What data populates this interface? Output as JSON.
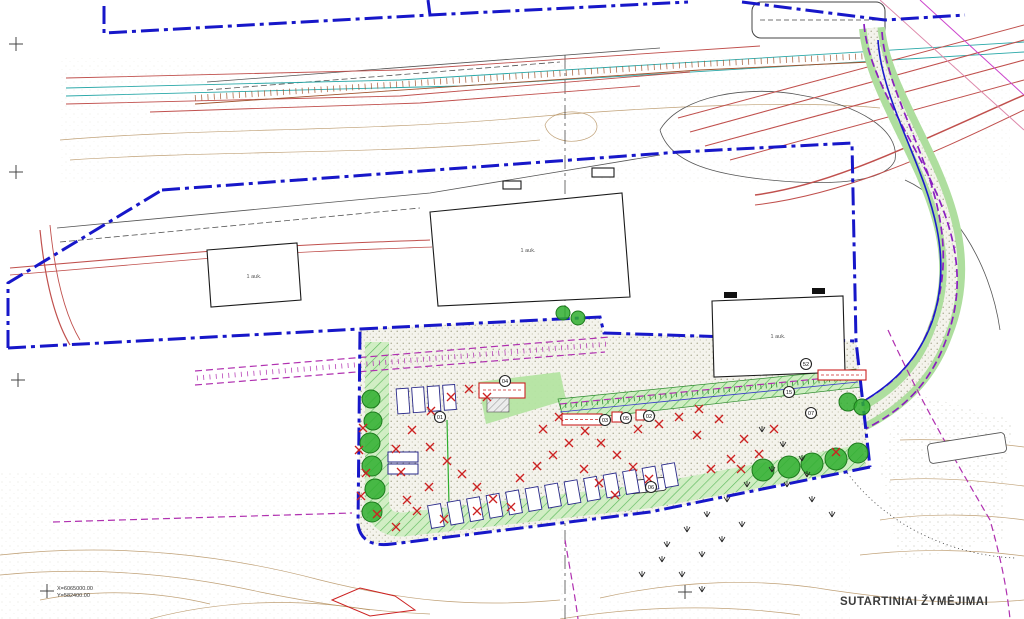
{
  "title": {
    "legend": "SUTARTINIAI ŽYMĖJIMAI"
  },
  "coordinates": {
    "x": "X=6065000.00",
    "y": "Y=582400.00"
  },
  "colors": {
    "boundary": "#1717c9",
    "magenta": "#b030b0",
    "purple": "#8a1fc0",
    "red": "#c0504d",
    "redx": "#cc2222",
    "teal": "#2aa8a8",
    "tree": "#2fae2f",
    "green_fill": "#aede9e"
  },
  "buildings": [
    {
      "label": "1 auk.",
      "x": 254,
      "y": 278
    },
    {
      "label": "1 auk.",
      "x": 528,
      "y": 252
    },
    {
      "label": "1 auk.",
      "x": 778,
      "y": 338
    }
  ],
  "markers": [
    {
      "id": "01",
      "x": 440,
      "y": 417
    },
    {
      "id": "04",
      "x": 505,
      "y": 381
    },
    {
      "id": "03",
      "x": 605,
      "y": 420
    },
    {
      "id": "05",
      "x": 626,
      "y": 418
    },
    {
      "id": "02",
      "x": 649,
      "y": 416
    },
    {
      "id": "06",
      "x": 651,
      "y": 487
    },
    {
      "id": "52",
      "x": 806,
      "y": 364
    },
    {
      "id": "15",
      "x": 789,
      "y": 392
    },
    {
      "id": "07",
      "x": 811,
      "y": 413
    }
  ],
  "red_x_points": [
    [
      363,
      428
    ],
    [
      359,
      450
    ],
    [
      366,
      473
    ],
    [
      361,
      496
    ],
    [
      377,
      514
    ],
    [
      396,
      527
    ],
    [
      407,
      500
    ],
    [
      401,
      472
    ],
    [
      396,
      449
    ],
    [
      412,
      430
    ],
    [
      430,
      447
    ],
    [
      447,
      461
    ],
    [
      462,
      474
    ],
    [
      477,
      487
    ],
    [
      493,
      499
    ],
    [
      511,
      507
    ],
    [
      429,
      487
    ],
    [
      417,
      511
    ],
    [
      444,
      519
    ],
    [
      477,
      511
    ],
    [
      520,
      478
    ],
    [
      537,
      466
    ],
    [
      553,
      455
    ],
    [
      569,
      443
    ],
    [
      585,
      431
    ],
    [
      601,
      443
    ],
    [
      617,
      455
    ],
    [
      633,
      467
    ],
    [
      649,
      479
    ],
    [
      584,
      469
    ],
    [
      599,
      483
    ],
    [
      615,
      495
    ],
    [
      559,
      417
    ],
    [
      543,
      429
    ],
    [
      431,
      411
    ],
    [
      451,
      397
    ],
    [
      469,
      389
    ],
    [
      487,
      397
    ],
    [
      638,
      429
    ],
    [
      659,
      424
    ],
    [
      679,
      417
    ],
    [
      699,
      409
    ],
    [
      719,
      419
    ],
    [
      744,
      439
    ],
    [
      759,
      454
    ],
    [
      774,
      429
    ],
    [
      741,
      469
    ],
    [
      711,
      469
    ],
    [
      697,
      435
    ],
    [
      731,
      459
    ],
    [
      836,
      452
    ]
  ],
  "tree_points": [
    [
      371,
      399,
      9
    ],
    [
      373,
      421,
      9
    ],
    [
      370,
      443,
      10
    ],
    [
      372,
      466,
      10
    ],
    [
      375,
      489,
      10
    ],
    [
      372,
      512,
      10
    ],
    [
      763,
      470,
      11
    ],
    [
      789,
      467,
      11
    ],
    [
      812,
      464,
      11
    ],
    [
      836,
      459,
      11
    ],
    [
      858,
      453,
      10
    ],
    [
      848,
      402,
      9
    ],
    [
      862,
      407,
      8
    ],
    [
      563,
      313,
      7
    ],
    [
      578,
      318,
      7
    ]
  ],
  "grass_points": [
    [
      762,
      432
    ],
    [
      783,
      447
    ],
    [
      802,
      461
    ],
    [
      772,
      472
    ],
    [
      747,
      487
    ],
    [
      727,
      502
    ],
    [
      707,
      517
    ],
    [
      687,
      532
    ],
    [
      667,
      547
    ],
    [
      702,
      557
    ],
    [
      722,
      542
    ],
    [
      742,
      527
    ],
    [
      812,
      502
    ],
    [
      832,
      517
    ],
    [
      682,
      577
    ],
    [
      702,
      592
    ],
    [
      662,
      562
    ],
    [
      642,
      577
    ],
    [
      787,
      487
    ],
    [
      807,
      477
    ]
  ],
  "cross_points": [
    [
      16,
      44
    ],
    [
      16,
      172
    ],
    [
      18,
      380
    ],
    [
      47,
      591
    ],
    [
      685,
      592
    ]
  ],
  "parking": {
    "rows": [
      {
        "x": 436,
        "y": 516,
        "count": 13,
        "dx": 19.5,
        "dy": -3.4,
        "w": 13,
        "h": 23,
        "angle": -10
      },
      {
        "x": 403,
        "y": 401,
        "count": 4,
        "dx": 15.5,
        "dy": -1.2,
        "w": 12,
        "h": 25,
        "angle": -4
      }
    ],
    "pads": [
      [
        388,
        452,
        30,
        10
      ],
      [
        388,
        464,
        30,
        10
      ]
    ]
  }
}
